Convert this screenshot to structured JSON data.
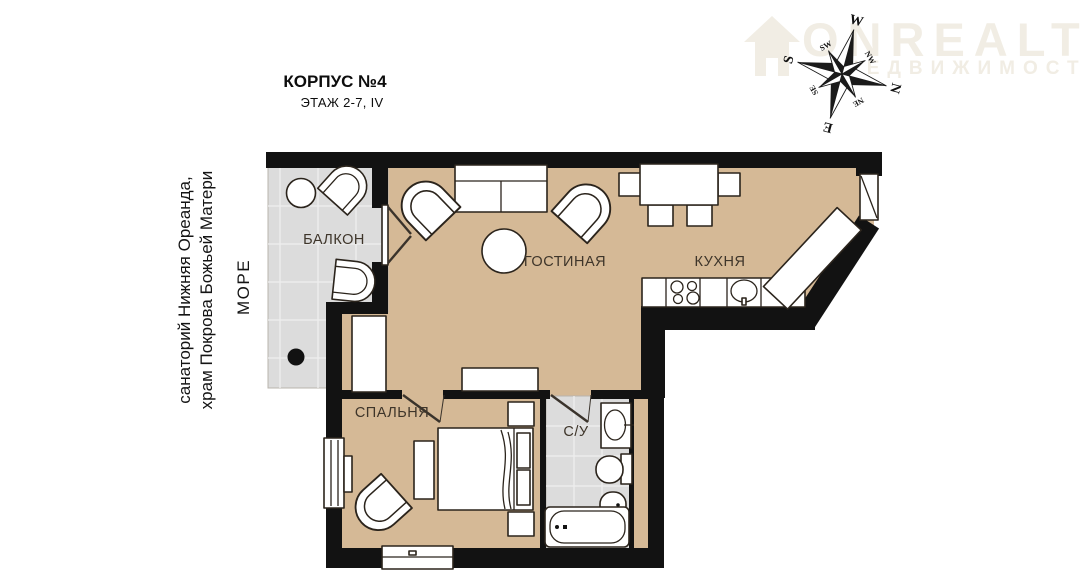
{
  "header": {
    "title": "КОРПУС №4",
    "subtitle": "ЭТАЖ 2-7, IV"
  },
  "side": {
    "landmarks_line1": "санаторий Нижняя Ореанда,",
    "landmarks_line2": "храм Покрова Божьей Матери",
    "sea": "МОРЕ"
  },
  "watermark": {
    "brand": "ONREALT",
    "tagline": "НЕДВИЖИМОСТЬ"
  },
  "compass": {
    "n": "N",
    "e": "E",
    "s": "S",
    "w": "W",
    "ne": "NE",
    "se": "SE",
    "sw": "SW",
    "nw": "NW"
  },
  "rooms": {
    "balcony": "БАЛКОН",
    "living": "ГОСТИНАЯ",
    "kitchen": "КУХНЯ",
    "bedroom": "СПАЛЬНЯ",
    "bathroom": "С/У"
  },
  "colors": {
    "floor": "#d5b996",
    "tile": "#dcdcdc",
    "wall": "#121212",
    "watermark": "#f1ede4"
  }
}
